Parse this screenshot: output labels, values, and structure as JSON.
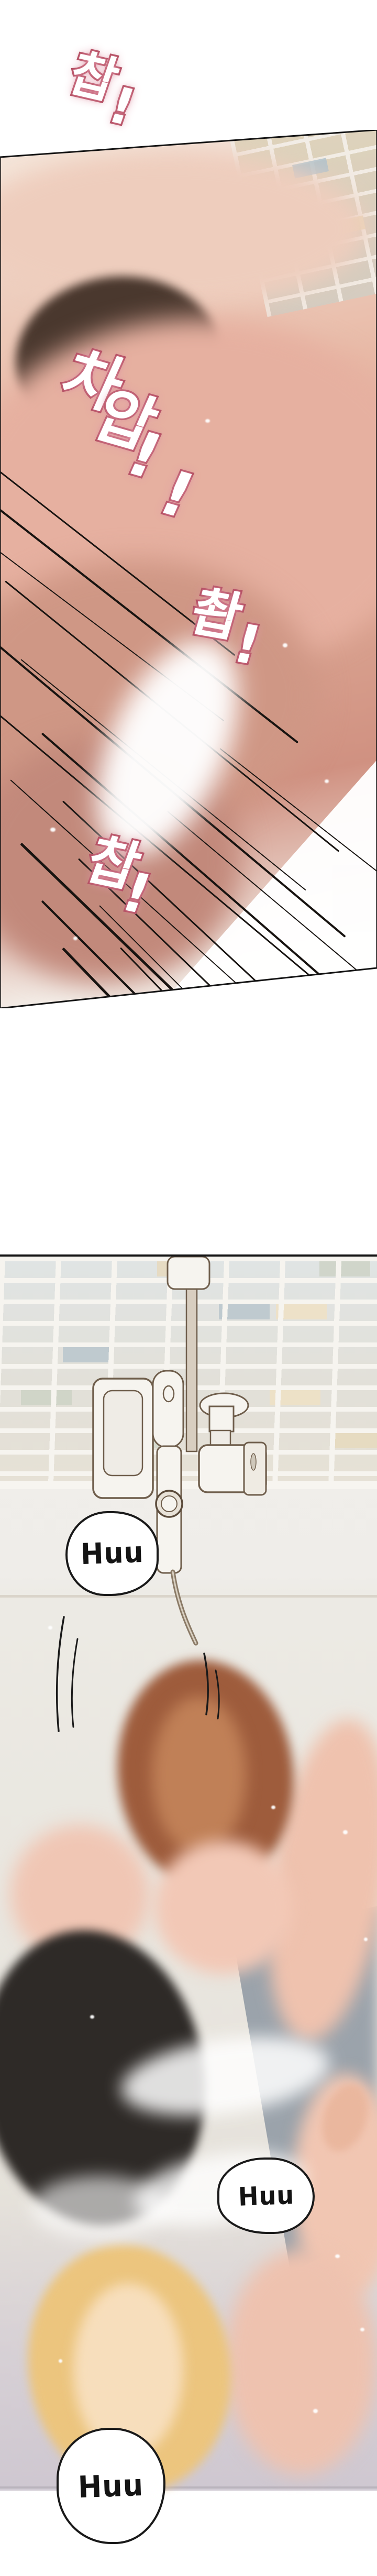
{
  "comic": {
    "panel1": {
      "sfx": [
        {
          "text": "찹!"
        },
        {
          "text": "차압!!"
        },
        {
          "text": "촵!"
        },
        {
          "text": "찹!"
        }
      ]
    },
    "panel2": {
      "speech_bubbles": [
        {
          "text": "Huu"
        },
        {
          "text": "Huu"
        },
        {
          "text": "Huu"
        }
      ]
    },
    "colors": {
      "page_background": "#ffffff",
      "panel_border": "#141414",
      "sfx_fill": "#ffffff",
      "sfx_stroke": "#ad4458",
      "sfx_glow": "#e39aab",
      "skin_light": "#f0c6b4",
      "skin_mid": "#dfa794",
      "skin_shadow": "#c08372",
      "hair_auburn": "#9e5c3c",
      "hair_dark": "#2e2a27",
      "hair_blonde": "#ecc57e",
      "tile_grout": "#f6f4ef",
      "tile_blue": "#b9c6cc",
      "tile_cream": "#eee0c4",
      "tile_green": "#ccd2c6",
      "tile_beige": "#e6d9bd",
      "wall": "#f0eeea",
      "floor_gray": "#9ba3ab",
      "fixture_white": "#f6f4ef",
      "fixture_outline": "#6f5e4c",
      "bubble_fill": "#ffffff",
      "bubble_stroke": "#191919",
      "bubble_text": "#141414"
    }
  }
}
